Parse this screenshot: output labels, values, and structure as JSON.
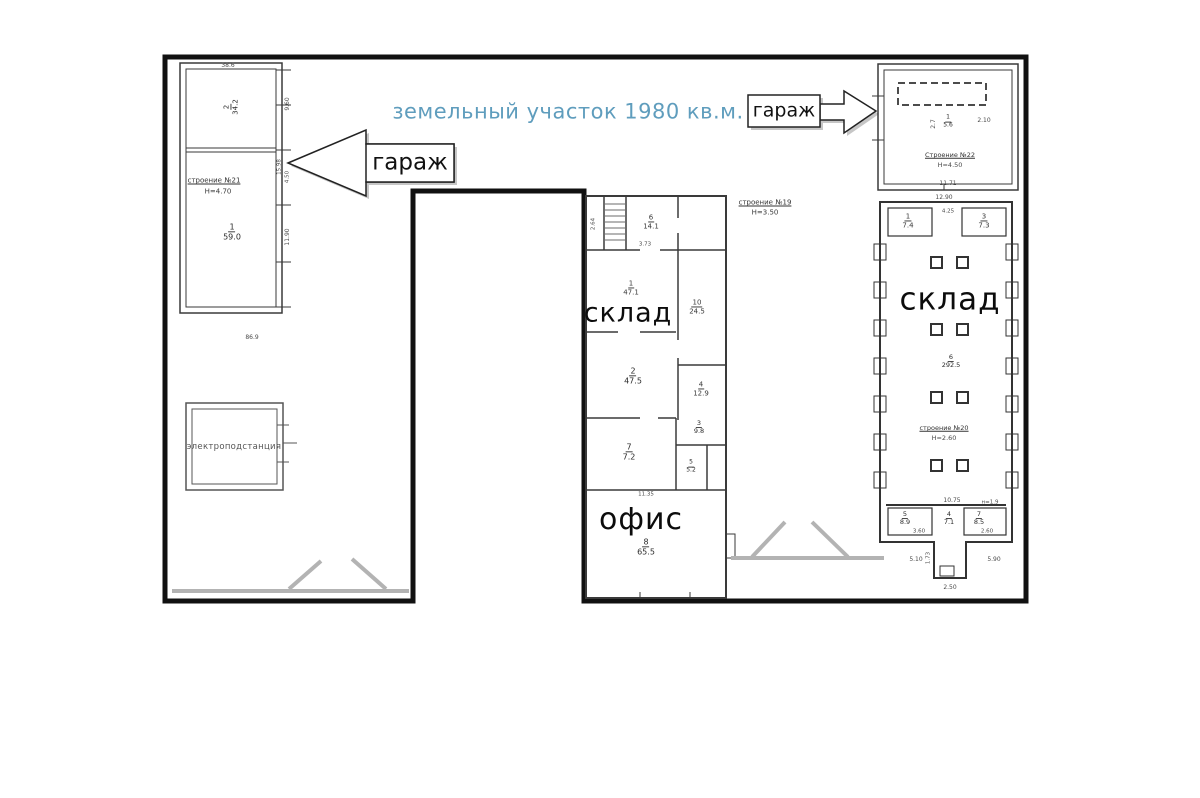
{
  "title": {
    "text": "земельный участок 1980 кв.м."
  },
  "arrow_labels": {
    "left": "гараж",
    "right": "гараж"
  },
  "left_garage": {
    "name": "строение №21",
    "height": "Н=4.70",
    "room_upper": {
      "num": "2",
      "area": "34.2"
    },
    "room_lower": {
      "num": "1",
      "area": "59.0"
    },
    "dim_top": "38.6",
    "dim_right_upper": "9.60",
    "dim_right_mid": "4.50",
    "dim_right_lower": "11.90",
    "dim_bottom": "86.9",
    "dim_side": "15.98"
  },
  "substation": {
    "label": "электроподстанция"
  },
  "right_garage": {
    "name": "Строение №22",
    "height": "Н=4.50",
    "room": {
      "num": "1",
      "area": "5.6"
    },
    "dim_left": "2.7",
    "dim_right": "2.10",
    "dim_bottom": "11.71"
  },
  "center_building": {
    "name": "строение №19",
    "height": "Н=3.50",
    "warehouse_label": "склад",
    "office_label": "офис",
    "rooms": {
      "r6": {
        "num": "6",
        "area": "14.1"
      },
      "r1": {
        "num": "1",
        "area": "47.1"
      },
      "r10": {
        "num": "10",
        "area": "24.5"
      },
      "r2": {
        "num": "2",
        "area": "47.5"
      },
      "r4": {
        "num": "4",
        "area": "12.9"
      },
      "r3": {
        "num": "3",
        "area": "9.8"
      },
      "r7": {
        "num": "7",
        "area": "7.2"
      },
      "r5": {
        "num": "5",
        "area": "5.2"
      },
      "r8": {
        "num": "8",
        "area": "65.5"
      }
    },
    "dims": {
      "d373": "3.73",
      "d1135": "11.35",
      "d264": "2.64"
    }
  },
  "right_warehouse": {
    "name": "строение №20",
    "height": "Н=2.60",
    "warehouse_label": "склад",
    "rooms": {
      "r1": {
        "num": "1",
        "area": "7.4"
      },
      "r3": {
        "num": "3",
        "area": "7.3"
      },
      "r6": {
        "num": "6",
        "area": "292.5"
      },
      "r5": {
        "num": "5",
        "area": "8.9"
      },
      "r4": {
        "num": "4",
        "area": "7.1"
      },
      "r7": {
        "num": "7",
        "area": "8.5"
      }
    },
    "dims": {
      "top": "12.90",
      "corridor": "4.25",
      "mid": "10.75",
      "note": "н=1.9",
      "left_room": "3.60",
      "right_room": "2.60",
      "bottom_left": "5.10",
      "bottom_right": "5.90",
      "passage_v": "1.73",
      "passage_b": "2.50"
    }
  },
  "colors": {
    "title": "#5f9dbd",
    "boundary": "#111111",
    "walls": "#3a3a3a",
    "gate": "#b3b3b3"
  }
}
